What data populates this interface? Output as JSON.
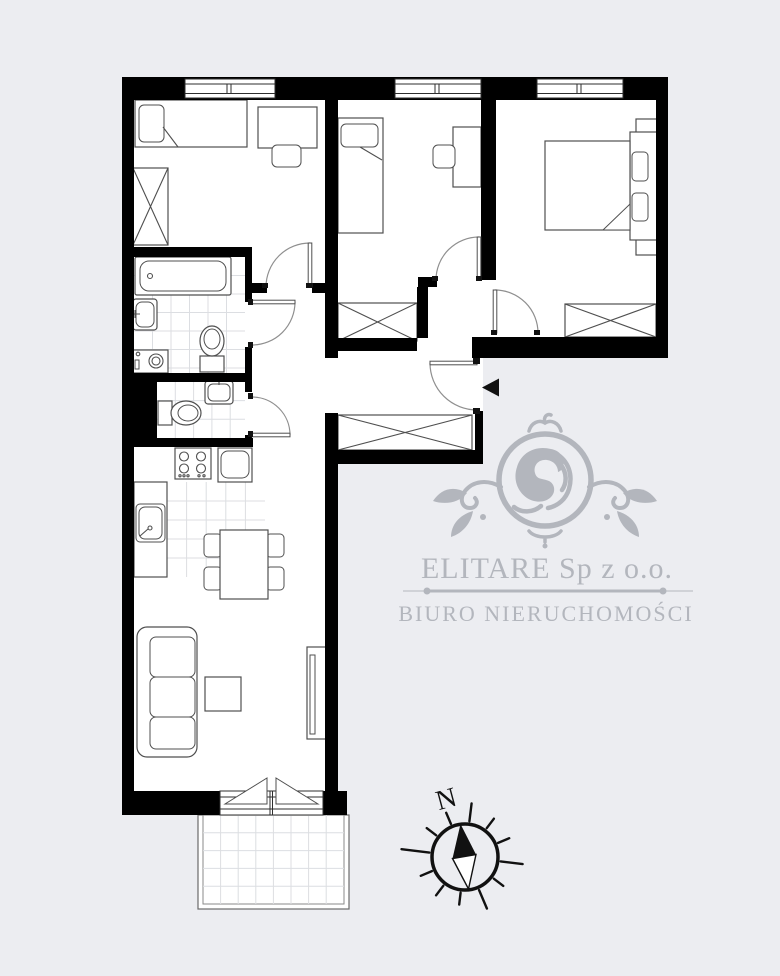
{
  "colors": {
    "background": "#ecedf1",
    "floor": "#ffffff",
    "wall": "#000000",
    "furniture_stroke": "#4f4f4f",
    "door_stroke": "#8f8f8f",
    "tile_line": "#dcdee2",
    "watermark": "#b3b6bd",
    "ink": "#111111"
  },
  "watermark": {
    "emblem": "lion-crest-icon",
    "company_name": "ELITARE Sp z o.o.",
    "subtitle": "BIURO NIERUCHOMOŚCI"
  },
  "compass": {
    "north_label": "N",
    "needle": "north-needle-icon"
  },
  "floor_plan": {
    "type": "apartment-floor-plan",
    "windows_count": 3,
    "entrance_marker": "black-left-arrow",
    "rooms": [
      {
        "name": "bedroom-1",
        "furniture": [
          "single-bed",
          "pillow",
          "desk",
          "chair",
          "wardrobe-x"
        ]
      },
      {
        "name": "bedroom-2",
        "furniture": [
          "single-bed",
          "pillow",
          "desk",
          "chair",
          "wardrobe-x"
        ]
      },
      {
        "name": "bedroom-3",
        "furniture": [
          "double-bed",
          "pillow",
          "pillow",
          "nightstand",
          "nightstand",
          "wardrobe-x"
        ]
      },
      {
        "name": "bathroom",
        "furniture": [
          "bathtub",
          "washbasin",
          "toilet",
          "washing-machine"
        ],
        "floor": "tiles"
      },
      {
        "name": "wc",
        "furniture": [
          "toilet",
          "washbasin"
        ],
        "floor": "tiles"
      },
      {
        "name": "kitchen",
        "furniture": [
          "stove-4-burners",
          "counter",
          "kitchen-sink",
          "dining-table",
          "chair",
          "chair",
          "chair",
          "chair"
        ],
        "floor": "tiles-partial"
      },
      {
        "name": "living-room",
        "furniture": [
          "sofa-3-seat",
          "coffee-table",
          "tv-cabinet"
        ]
      },
      {
        "name": "hallway",
        "furniture": [
          "wardrobe-x",
          "wardrobe-x"
        ]
      },
      {
        "name": "balcony",
        "furniture": [],
        "floor": "tiles"
      }
    ],
    "doors": [
      "bedroom-1-door",
      "bedroom-2-door",
      "bedroom-3-door",
      "bathroom-door",
      "wc-door",
      "entrance-door",
      "balcony-double-door"
    ]
  }
}
